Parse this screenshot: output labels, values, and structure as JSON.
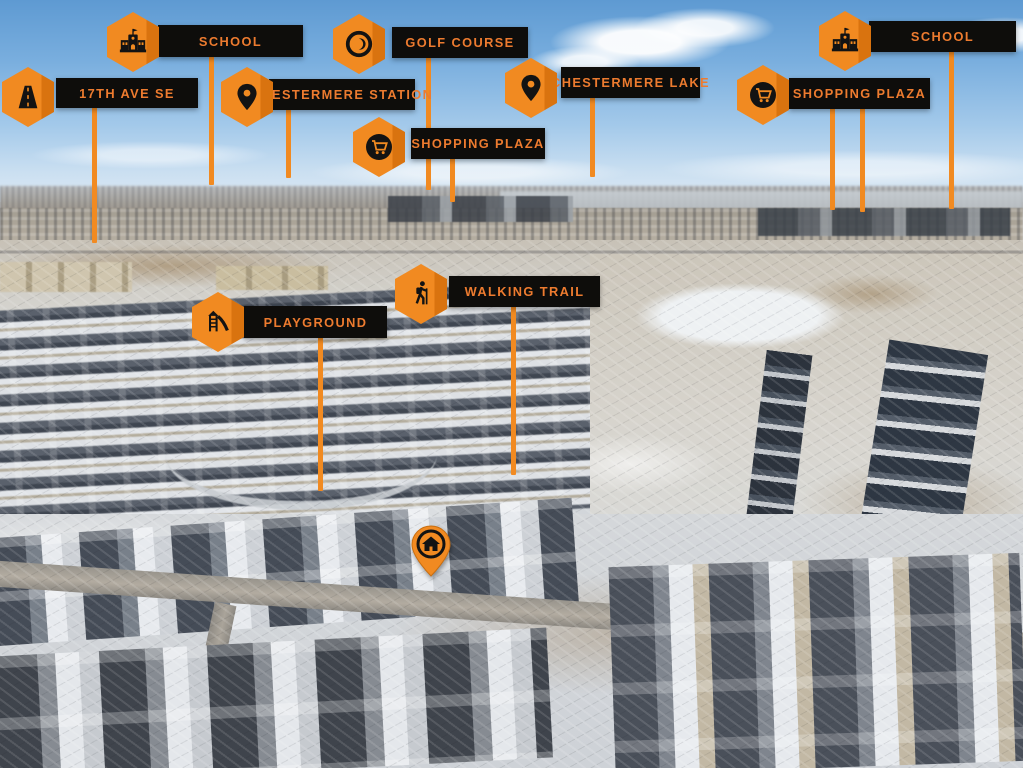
{
  "colors": {
    "accent_orange": "#F18A21",
    "accent_orange_dark": "#D9730F",
    "label_background": "#0E0D0B",
    "label_text": "#ED7B2F"
  },
  "markers": {
    "school_left": {
      "label": "SCHOOL",
      "icon": "school-icon"
    },
    "golf_course": {
      "label": "GOLF COURSE",
      "icon": "golf-icon"
    },
    "school_right": {
      "label": "SCHOOL",
      "icon": "school-icon"
    },
    "ave_17th_se": {
      "label": "17TH AVE SE",
      "icon": "road-icon"
    },
    "chestermere_station": {
      "label": "CHESTERMERE STATION",
      "icon": "map-pin-icon"
    },
    "chestermere_lake": {
      "label": "CHESTERMERE LAKE",
      "icon": "map-pin-icon"
    },
    "shopping_plaza_mid": {
      "label": "SHOPPING PLAZA",
      "icon": "cart-icon"
    },
    "shopping_plaza_right": {
      "label": "SHOPPING PLAZA",
      "icon": "cart-icon"
    },
    "walking_trail": {
      "label": "WALKING TRAIL",
      "icon": "hiker-icon"
    },
    "playground": {
      "label": "PLAYGROUND",
      "icon": "playground-icon"
    },
    "subject_home": {
      "icon": "home-pin-icon"
    }
  }
}
